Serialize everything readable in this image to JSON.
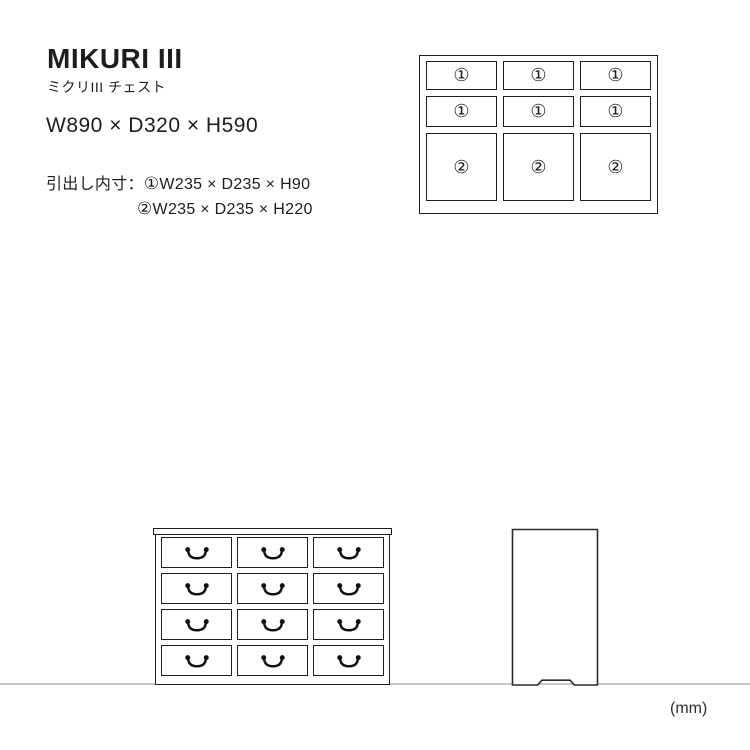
{
  "product": {
    "title": "MIKURI III",
    "subtitle": "ミクリIII チェスト",
    "overall_dimensions": "W890 × D320 × H590",
    "drawer_section_label": "引出し内寸：",
    "drawer_specs": [
      {
        "mark": "①",
        "text": "W235 × D235 × H90"
      },
      {
        "mark": "②",
        "text": "W235 × D235 × H220"
      }
    ],
    "unit_label": "(mm)"
  },
  "top_view_diagram": {
    "description": "front schematic with drawer size marks, 3 columns x 3 rows",
    "cells": [
      [
        "①",
        "①",
        "①"
      ],
      [
        "①",
        "①",
        "①"
      ],
      [
        "②",
        "②",
        "②"
      ]
    ]
  },
  "front_view_diagram": {
    "description": "front elevation, 3 columns x 4 drawer rows with drop handles",
    "columns": 3,
    "rows": 4,
    "handle_icon": "drop-handle"
  },
  "side_view_diagram": {
    "description": "side elevation with base notch"
  },
  "colors": {
    "line": "#1d1d1d",
    "ground_line": "#c8c8c8",
    "background": "#ffffff",
    "text": "#1d1d1d"
  }
}
